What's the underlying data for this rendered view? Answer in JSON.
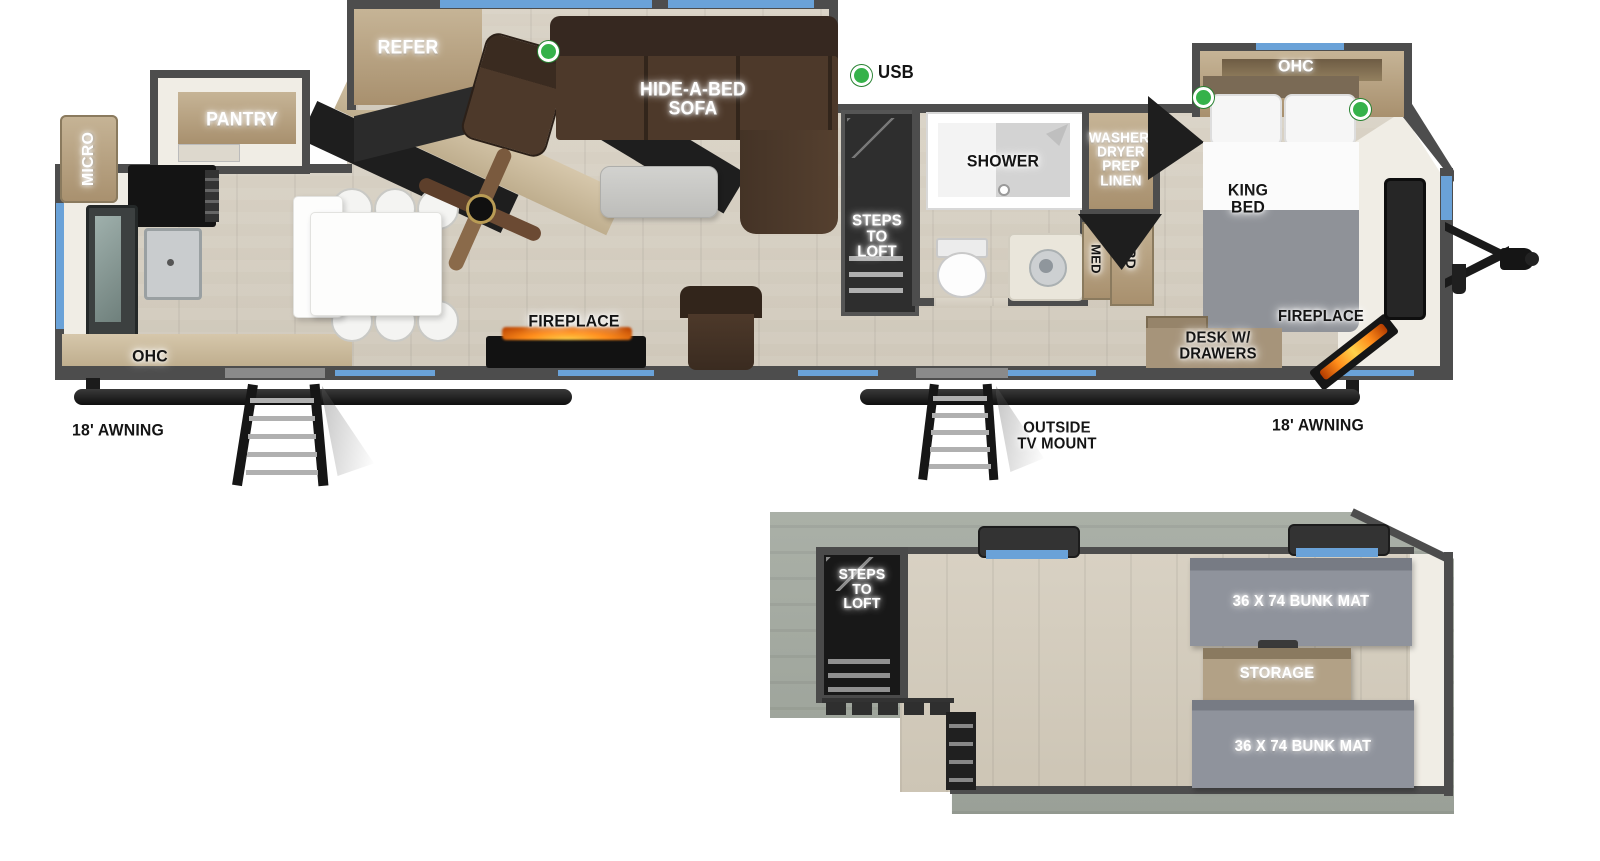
{
  "colors": {
    "wall": "#4d4d4d",
    "floor_wood": "#d5cec1",
    "cabinet_wood": "#b5a488",
    "sofa_brown": "#4a3628",
    "window_blue": "#6aa2d8",
    "usb_green": "#35b24a",
    "bunk_gray": "#8a8e97",
    "flame_orange": "#ff8c1a"
  },
  "main_floor": {
    "kitchen": {
      "micro": "MICRO",
      "ohc": "OHC",
      "pantry": "PANTRY"
    },
    "living": {
      "refer": "REFER",
      "sofa": "HIDE-A-BED\nSOFA",
      "fireplace": "FIREPLACE",
      "usb": "USB"
    },
    "loft_access": {
      "steps": "STEPS\nTO\nLOFT"
    },
    "bath": {
      "shower": "SHOWER",
      "washer": "WASHER/\nDRYER\nPREP\nLINEN",
      "med": "MED",
      "ward": "WARD"
    },
    "bedroom": {
      "ohc": "OHC",
      "king_bed": "KING\nBED",
      "desk": "DESK W/\nDRAWERS",
      "fireplace": "FIREPLACE"
    },
    "exterior": {
      "awning_left": "18' AWNING",
      "awning_right": "18' AWNING",
      "tv_mount": "OUTSIDE\nTV MOUNT"
    }
  },
  "loft": {
    "steps": "STEPS\nTO\nLOFT",
    "bunk_front": "36 X 74 BUNK MAT",
    "storage": "STORAGE",
    "bunk_rear": "36 X 74 BUNK MAT"
  }
}
